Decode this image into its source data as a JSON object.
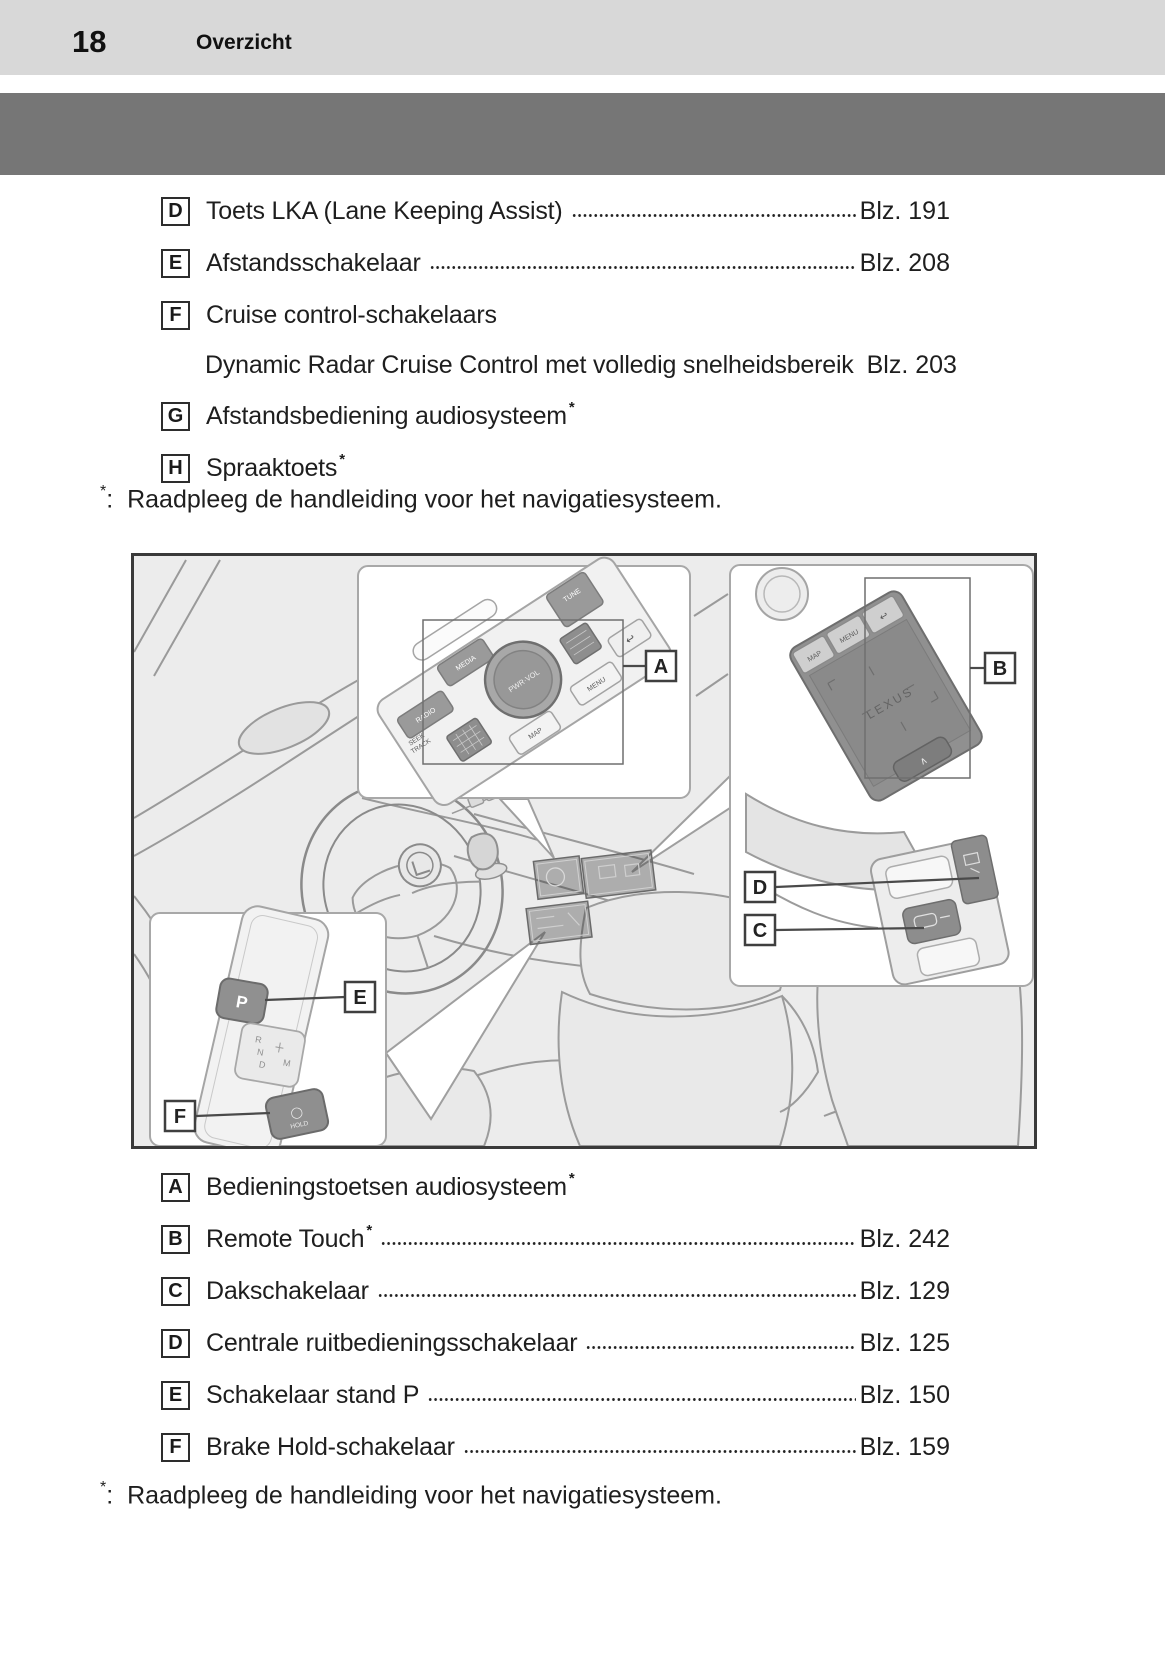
{
  "page": {
    "number": "18",
    "section_title": "Overzicht"
  },
  "colors": {
    "header_band": "#d8d8d8",
    "photo_band": "#767676",
    "figure_bg": "#ececec",
    "text": "#1c1c1c"
  },
  "top_list": {
    "items": [
      {
        "label": "D",
        "text": "Toets LKA (Lane Keeping Assist)",
        "page": "Blz. 191"
      },
      {
        "label": "E",
        "text": "Afstandsschakelaar",
        "page": "Blz. 208"
      },
      {
        "label": "F",
        "text": "Cruise control-schakelaars",
        "subitem": {
          "text": "Dynamic Radar Cruise Control met volledig snelheidsbereik",
          "page": "Blz. 203"
        }
      },
      {
        "label": "G",
        "text": "Afstandsbediening audiosysteem",
        "asterisk": "*"
      },
      {
        "label": "H",
        "text": "Spraaktoets",
        "asterisk": "*"
      }
    ],
    "footnote": {
      "symbol": "*",
      "separator": ":",
      "text": "Raadpleeg de handleiding voor het navigatiesysteem."
    }
  },
  "bottom_list": {
    "items": [
      {
        "label": "A",
        "text": "Bedieningstoetsen audiosysteem",
        "asterisk": "*"
      },
      {
        "label": "B",
        "text": "Remote Touch",
        "asterisk": "*",
        "page": "Blz. 242"
      },
      {
        "label": "C",
        "text": "Dakschakelaar",
        "page": "Blz. 129"
      },
      {
        "label": "D",
        "text": "Centrale ruitbedieningsschakelaar",
        "page": "Blz. 125"
      },
      {
        "label": "E",
        "text": "Schakelaar stand P",
        "page": "Blz. 150"
      },
      {
        "label": "F",
        "text": "Brake Hold-schakelaar",
        "page": "Blz. 159"
      }
    ],
    "footnote": {
      "symbol": "*",
      "separator": ":",
      "text": "Raadpleeg de handleiding voor het navigatiesysteem."
    }
  },
  "figure": {
    "callouts": {
      "a": "A",
      "b": "B",
      "c": "C",
      "d": "D",
      "e": "E",
      "f": "F"
    },
    "audio_panel": {
      "radio": "RADIO",
      "media": "MEDIA",
      "tune": "TUNE",
      "seek": "SEEK",
      "track": "TRACK",
      "knob": "PWR·VOL",
      "map": "MAP",
      "menu": "MENU",
      "back": "↩"
    },
    "remote_touch": {
      "map": "MAP",
      "menu": "MENU",
      "back": "↩",
      "brand": "LEXUS",
      "enter": "∧"
    },
    "shifter": {
      "park": "P",
      "r": "R",
      "n": "N",
      "d": "D",
      "m": "M",
      "hold_icon": "◯",
      "hold": "HOLD"
    }
  }
}
